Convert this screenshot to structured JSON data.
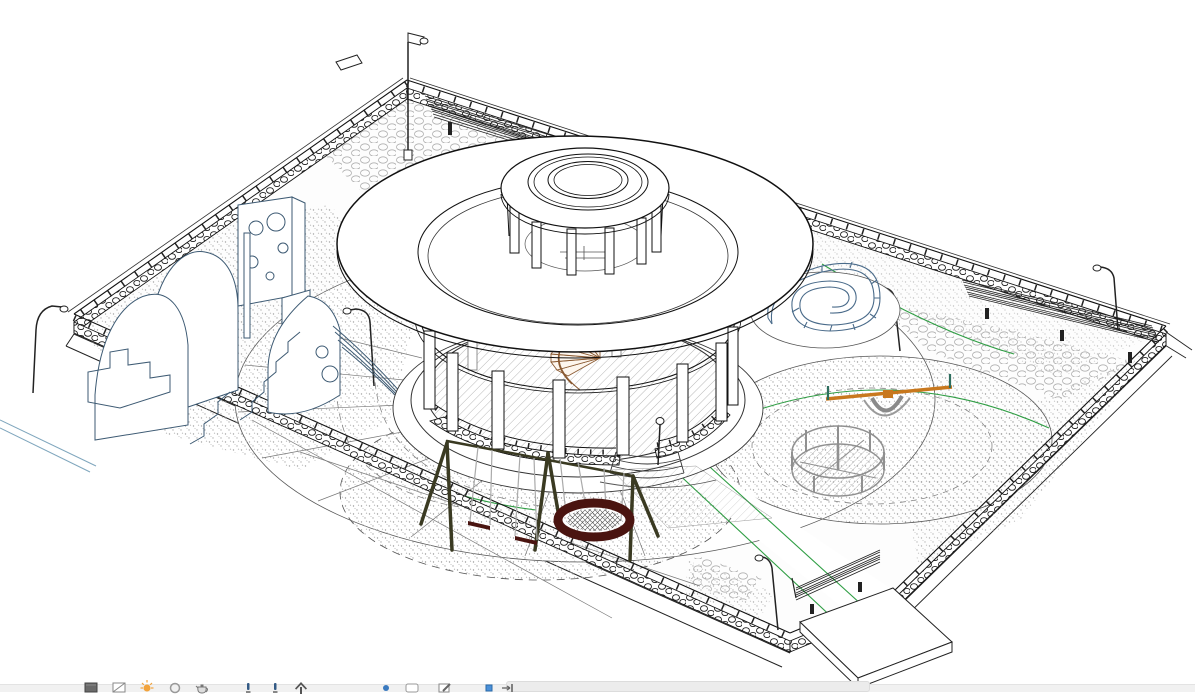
{
  "app": {
    "type": "cad-3d-viewport",
    "background": "#ffffff"
  },
  "canvas": {
    "description": "Isometric 3D CAD line drawing of a park / playground with a central circular pavilion under a wide disc roof"
  },
  "scene": {
    "elements": [
      "perimeter stone wall with railing",
      "circular pavilion",
      "disc roof with clerestory drum",
      "spiral staircase",
      "stone knee walls",
      "entrance steps with lamp",
      "playground climber with slide",
      "swing set with nest swing",
      "seesaw",
      "merry-go-round",
      "spiral bench wall",
      "park benches",
      "street lamps",
      "sand surfacing",
      "cobblestone paving",
      "pathway with green edge lines",
      "entrance slab"
    ]
  },
  "colors": {
    "line": "#1a1a1a",
    "line_soft": "#666666",
    "green_accent": "#2f9e44",
    "playground_blue": "#3d5a73",
    "swing_frame_olive": "#3a3a22",
    "swing_seat_maroon": "#4a1410",
    "rope_gray": "#aaaaaa",
    "seesaw_orange": "#c8781e",
    "seesaw_teal": "#2e6e5e",
    "carousel_gray": "#909090",
    "stair_tan": "#8a5a32",
    "spiral_blue": "#4a6b8a",
    "paving_gray": "#b0b0b0",
    "sand_dot": "#9a9a9a",
    "curb_blue": "#7fa6bd",
    "sun_icon": "#f2a33c",
    "icon_blue": "#335a85",
    "icon_bright_blue": "#3a7abf",
    "icon_gray": "#6b6b6b",
    "statusbar_bg": "#f1f1f1"
  },
  "status_bar": {
    "icons": [
      {
        "id": "visual-style-icon",
        "label": "visual style"
      },
      {
        "id": "detail-level-icon",
        "label": "detail level"
      },
      {
        "id": "sun-path-icon",
        "label": "sun path"
      },
      {
        "id": "shadows-icon",
        "label": "shadows"
      },
      {
        "id": "rendering-icon",
        "label": "show rendering dialog"
      },
      {
        "id": "hide-isolate-icon",
        "label": "temporary hide isolate"
      },
      {
        "id": "reveal-hidden-icon",
        "label": "reveal hidden elements"
      },
      {
        "id": "crop-view-icon",
        "label": "crop view"
      },
      {
        "id": "properties-dot-icon",
        "label": "view properties"
      },
      {
        "id": "temporary-view-icon",
        "label": "temporary view properties"
      },
      {
        "id": "edit-box-icon",
        "label": "edit"
      },
      {
        "id": "analytical-model-icon",
        "label": "analytical model"
      },
      {
        "id": "displacement-icon",
        "label": "displacement sets"
      }
    ]
  }
}
